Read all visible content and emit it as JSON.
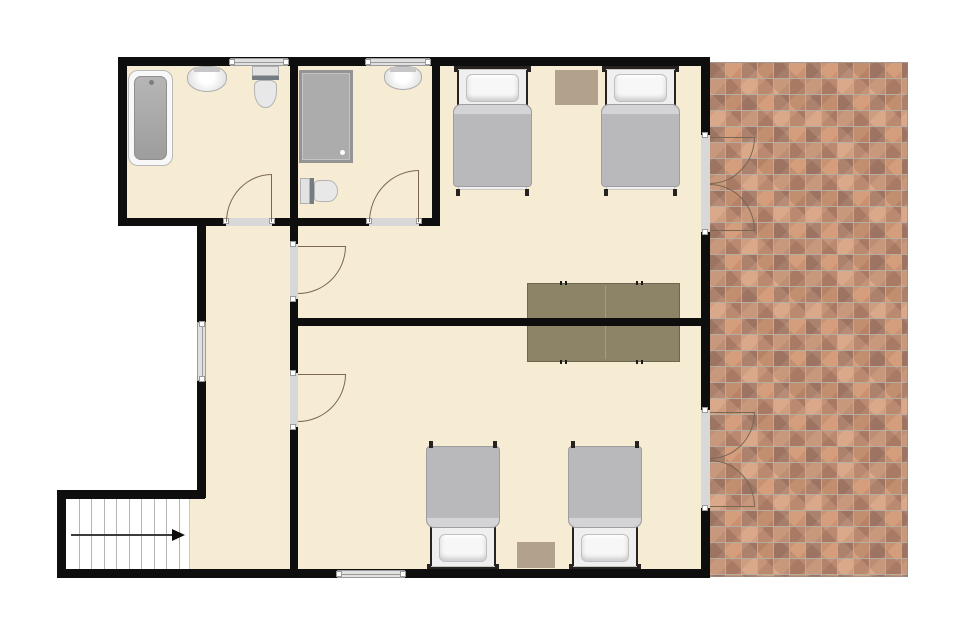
{
  "canvas": {
    "width": 960,
    "height": 640,
    "background": "#ffffff"
  },
  "palette": {
    "floor": "#f6ecd4",
    "wall": "#0e0e0e",
    "window_fill": "#e0e0e0",
    "window_line": "#9b9b9b",
    "sill": "#d8d8d8",
    "door_arc": "#7b6651",
    "table": "#8d8366",
    "rug": "#b2a18b",
    "bed_blanket": "#b9b9bb",
    "bed_frame": "#26221f",
    "brick_a": "#cb9372",
    "brick_b": "#b9876e",
    "brick_c": "#d3a183",
    "brick_d": "#a87e6a",
    "grout": "#b5aca4",
    "stairs_line": "#b4b4b4",
    "arrow": "#3c3c3c"
  },
  "plan": {
    "floors": [
      [
        122,
        60,
        586,
        163
      ],
      [
        201,
        222,
        507,
        350
      ],
      [
        188,
        498,
        17,
        74
      ]
    ],
    "walls": [
      [
        118,
        57,
        592,
        9
      ],
      [
        118,
        57,
        9,
        169
      ],
      [
        701,
        57,
        9,
        78
      ],
      [
        701,
        232,
        9,
        178
      ],
      [
        701,
        508,
        9,
        70
      ],
      [
        57,
        569,
        653,
        9
      ],
      [
        57,
        490,
        9,
        88
      ],
      [
        57,
        490,
        148,
        9
      ],
      [
        197,
        218,
        9,
        104
      ],
      [
        197,
        381,
        9,
        117
      ],
      [
        118,
        218,
        108,
        8
      ],
      [
        272,
        218,
        97,
        8
      ],
      [
        419,
        218,
        21,
        8
      ],
      [
        290,
        57,
        8,
        169
      ],
      [
        432,
        57,
        8,
        169
      ],
      [
        290,
        218,
        8,
        26
      ],
      [
        290,
        299,
        8,
        74
      ],
      [
        290,
        427,
        8,
        143
      ],
      [
        290,
        318,
        420,
        8
      ]
    ],
    "windows": [
      {
        "x": 230,
        "y": 58,
        "w": 58,
        "h": 8,
        "dir": "h"
      },
      {
        "x": 366,
        "y": 58,
        "w": 64,
        "h": 8,
        "dir": "h"
      },
      {
        "x": 197,
        "y": 322,
        "w": 9,
        "h": 59,
        "dir": "v"
      },
      {
        "x": 337,
        "y": 570,
        "w": 68,
        "h": 8,
        "dir": "h"
      }
    ],
    "door_sills": [
      {
        "x": 226,
        "y": 218,
        "w": 46,
        "h": 8,
        "dir": "h"
      },
      {
        "x": 369,
        "y": 218,
        "w": 50,
        "h": 8,
        "dir": "h"
      },
      {
        "x": 290,
        "y": 244,
        "w": 8,
        "h": 55,
        "dir": "v"
      },
      {
        "x": 290,
        "y": 373,
        "w": 8,
        "h": 54,
        "dir": "v"
      },
      {
        "x": 701,
        "y": 135,
        "w": 9,
        "h": 97,
        "dir": "v"
      },
      {
        "x": 701,
        "y": 410,
        "w": 9,
        "h": 98,
        "dir": "v"
      }
    ],
    "door_leaves": [
      {
        "x": 226,
        "y": 174,
        "w": 46,
        "h": 48,
        "corner": "tl",
        "open": "bottom"
      },
      {
        "x": 369,
        "y": 170,
        "w": 50,
        "h": 52,
        "corner": "tl",
        "open": "bottom"
      },
      {
        "x": 298,
        "y": 246,
        "w": 48,
        "h": 48,
        "corner": "br",
        "open": "left"
      },
      {
        "x": 298,
        "y": 374,
        "w": 48,
        "h": 48,
        "corner": "br",
        "open": "left"
      },
      {
        "x": 710,
        "y": 137,
        "w": 45,
        "h": 47,
        "corner": "br",
        "open": "left"
      },
      {
        "x": 710,
        "y": 184,
        "w": 45,
        "h": 47,
        "corner": "tr",
        "open": "left"
      },
      {
        "x": 710,
        "y": 412,
        "w": 45,
        "h": 47,
        "corner": "br",
        "open": "left"
      },
      {
        "x": 710,
        "y": 460,
        "w": 45,
        "h": 47,
        "corner": "tr",
        "open": "left"
      }
    ],
    "patio": {
      "x": 708,
      "y": 62,
      "w": 200,
      "h": 515
    },
    "stairs": {
      "x": 65,
      "y": 498,
      "w": 125,
      "h": 72,
      "treads": 10
    },
    "furniture": {
      "beds": [
        {
          "x": 454,
          "y": 66,
          "w": 77,
          "h": 130,
          "head": "top"
        },
        {
          "x": 602,
          "y": 66,
          "w": 77,
          "h": 130,
          "head": "top"
        },
        {
          "x": 427,
          "y": 441,
          "w": 72,
          "h": 129,
          "head": "bottom"
        },
        {
          "x": 569,
          "y": 441,
          "w": 72,
          "h": 129,
          "head": "bottom"
        }
      ],
      "rugs": [
        {
          "x": 555,
          "y": 70,
          "w": 43,
          "h": 35
        },
        {
          "x": 517,
          "y": 542,
          "w": 38,
          "h": 26
        }
      ],
      "table": {
        "x": 527,
        "y": 283,
        "w": 153,
        "h": 79,
        "ticks": [
          32,
          37,
          108,
          113
        ]
      },
      "bathtub": {
        "x": 128,
        "y": 70,
        "w": 45,
        "h": 96
      },
      "shower": {
        "x": 299,
        "y": 70,
        "w": 54,
        "h": 93
      },
      "sinks": [
        {
          "x": 187,
          "y": 66,
          "w": 40,
          "h": 26
        },
        {
          "x": 384,
          "y": 66,
          "w": 38,
          "h": 24
        }
      ],
      "toilets": [
        {
          "x": 252,
          "y": 66,
          "w": 27,
          "h": 42,
          "tank": "top"
        },
        {
          "x": 300,
          "y": 178,
          "w": 38,
          "h": 26,
          "tank": "left"
        }
      ]
    }
  }
}
